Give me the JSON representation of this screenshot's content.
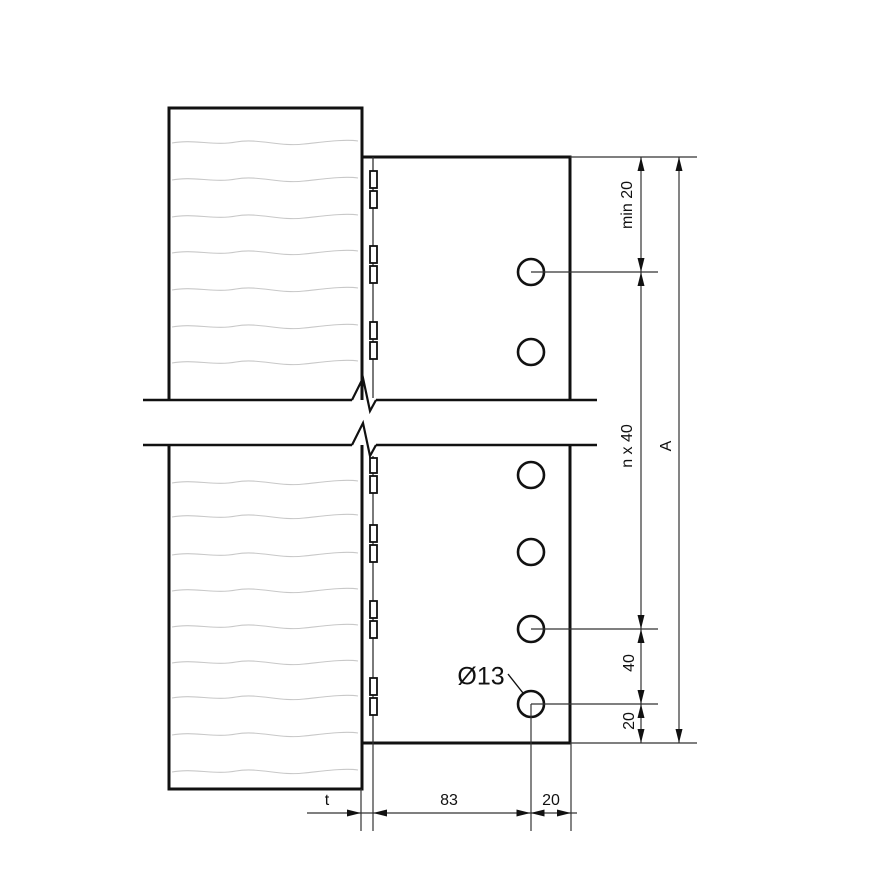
{
  "drawing": {
    "type": "technical-connection-detail",
    "views": [
      "upper-section",
      "lower-section"
    ],
    "parts": [
      "timber-member",
      "steel-plate",
      "weld-stitches",
      "bolt-holes"
    ]
  },
  "labels": {
    "dim_min_edge": "min 20",
    "dim_pitch": "n x 40",
    "dim_40": "40",
    "dim_20_vertical": "20",
    "dim_total_height": "A",
    "dim_plate_thickness": "t",
    "dim_83": "83",
    "dim_20_horizontal": "20",
    "hole_diameter": "Ø13"
  },
  "holes": {
    "diameter_label": "Ø13",
    "upper_section_count": 2,
    "lower_section_count": 4
  },
  "colors": {
    "background": "#ffffff",
    "outline": "#111111",
    "thin_line": "#333333",
    "grain_line": "#c8c8c8",
    "text": "#111111"
  }
}
